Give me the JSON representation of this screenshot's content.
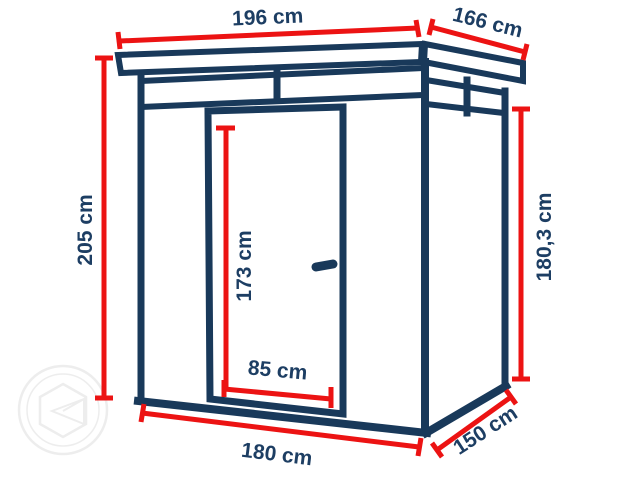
{
  "diagram": {
    "title": "shed-dimension-diagram",
    "colors": {
      "line_navy": "#19395a",
      "label_navy": "#1d3e63",
      "dimension_red": "#ec1313",
      "watermark_gray": "#ededed",
      "background": "#ffffff"
    },
    "dimensions": {
      "roof_width": "196 cm",
      "roof_depth": "166 cm",
      "total_height": "205 cm",
      "side_height": "180,3 cm",
      "door_height": "173 cm",
      "door_width": "85 cm",
      "base_width": "180 cm",
      "base_depth": "150 cm"
    }
  }
}
